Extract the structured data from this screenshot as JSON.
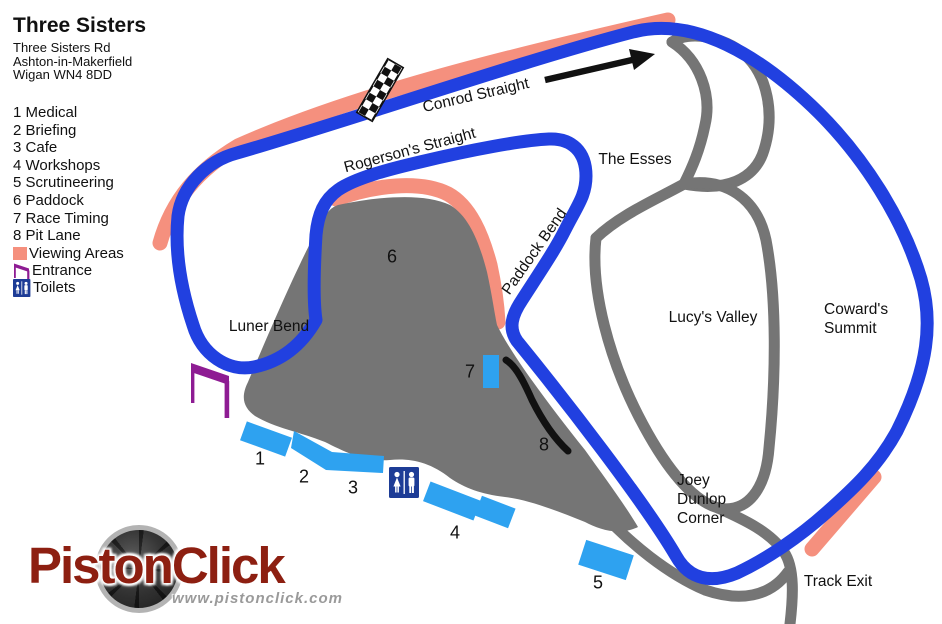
{
  "map_title": {
    "title": "Three Sisters",
    "address_lines": [
      "Three Sisters Rd",
      "Ashton-in-Makerfield",
      "Wigan WN4 8DD"
    ]
  },
  "legend": {
    "items": [
      {
        "num": "1",
        "label": "Medical"
      },
      {
        "num": "2",
        "label": "Briefing"
      },
      {
        "num": "3",
        "label": "Cafe"
      },
      {
        "num": "4",
        "label": "Workshops"
      },
      {
        "num": "5",
        "label": "Scrutineering"
      },
      {
        "num": "6",
        "label": "Paddock"
      },
      {
        "num": "7",
        "label": "Race Timing"
      },
      {
        "num": "8",
        "label": "Pit Lane"
      }
    ],
    "viewing_label": "Viewing Areas",
    "entrance_label": "Entrance",
    "toilets_label": "Toilets"
  },
  "track_labels": {
    "conrod": "Conrod Straight",
    "rogersons": "Rogerson's Straight",
    "esses": "The Esses",
    "paddock_bend": "Paddock Bend",
    "lucys": "Lucy's Valley",
    "luner": "Luner Bend",
    "track_exit": "Track Exit",
    "cowards_lines": [
      "Coward's",
      "Summit"
    ],
    "joey_lines": [
      "Joey",
      "Dunlop",
      "Corner"
    ]
  },
  "markers": [
    "1",
    "2",
    "3",
    "4",
    "5",
    "6",
    "7",
    "8"
  ],
  "logo": {
    "brand": "PistonClick",
    "website": "www.pistonclick.com"
  },
  "icons": {
    "viewing_swatch": "salmon-square",
    "entrance": "entrance-gate-flag",
    "toilets": "male-female-wc",
    "start_finish": "checkered-flag-strip",
    "direction": "black-arrow-right",
    "logo_mark": "camera-aperture"
  },
  "colors": {
    "track_blue": "#2140E0",
    "viewing_salmon": "#F5907E",
    "inner_track_gray": "#757575",
    "building_blue": "#2EA2F0",
    "toilets_navy": "#1D3C96",
    "entrance_purple": "#8E1C93",
    "pit_lane_black": "#111111",
    "logo_red": "#8D1F11"
  }
}
